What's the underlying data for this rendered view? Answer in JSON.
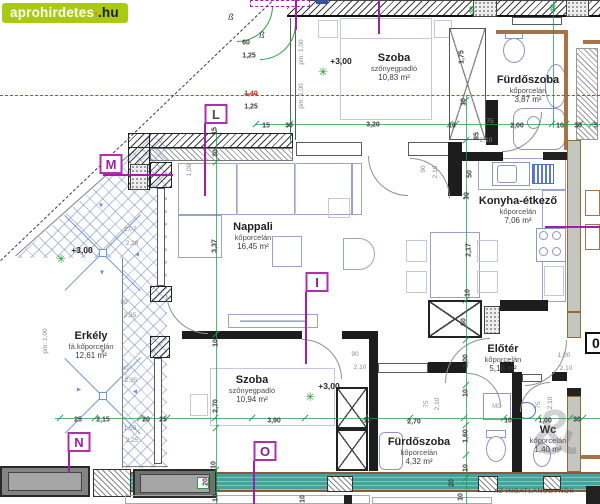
{
  "site_badge": {
    "name": "aprohirdetes",
    "dot": "▪",
    "tld": ".hu"
  },
  "colors": {
    "logo_green": "#a9ca10",
    "logo_orange": "#f07a00",
    "marker_magenta": "#b12fae",
    "dim_green": "#1f9e4c",
    "axis_red": "#cd3b2c",
    "balcony_teal": "#47a29a",
    "wall_brown": "#a97147",
    "hatch_blue": "#7d8cc3"
  },
  "rooms": [
    {
      "name": "Szoba",
      "floor": "szőnyegpadló",
      "area": "10,83 m²",
      "x": 394,
      "y": 52
    },
    {
      "name": "Fürdőszoba",
      "floor": "kőporcelán",
      "area": "3,87 m²",
      "x": 528,
      "y": 74
    },
    {
      "name": "Nappali",
      "floor": "kőporcelán",
      "area": "16,45 m²",
      "x": 253,
      "y": 221
    },
    {
      "name": "Konyha-étkező",
      "floor": "kőporcelán",
      "area": "7,06 m²",
      "x": 518,
      "y": 195
    },
    {
      "name": "Erkély",
      "floor": "fá.kőporcelán",
      "area": "12,61 m²",
      "x": 91,
      "y": 330
    },
    {
      "name": "Szoba",
      "floor": "szőnyegpadló",
      "area": "10,94 m²",
      "x": 252,
      "y": 374
    },
    {
      "name": "Fürdőszoba",
      "floor": "kőporcelán",
      "area": "4,32 m²",
      "x": 419,
      "y": 436
    },
    {
      "name": "Előtér",
      "floor": "kőporcelán",
      "area": "5,18 m²",
      "x": 503,
      "y": 343
    },
    {
      "name": "Wc",
      "floor": "kőporcelán",
      "area": "1,40 m²",
      "x": 548,
      "y": 424
    }
  ],
  "markers": [
    {
      "letter": "L",
      "x": 216,
      "y": 114,
      "color": "#4a4a4a"
    },
    {
      "letter": "M",
      "x": 111,
      "y": 164,
      "color": "#a021a0"
    },
    {
      "letter": "I",
      "x": 317,
      "y": 282,
      "color": "#7d2580"
    },
    {
      "letter": "N",
      "x": 79,
      "y": 442,
      "color": "#a021a0"
    },
    {
      "letter": "O",
      "x": 265,
      "y": 451,
      "color": "#7d2580"
    }
  ],
  "levels": [
    {
      "label": "+3,00",
      "x": 341,
      "y": 61,
      "star_x": 323,
      "star_y": 72
    },
    {
      "label": "+3,00",
      "x": 82,
      "y": 250,
      "star_x": 61,
      "star_y": 259
    },
    {
      "label": "+3,00",
      "x": 329,
      "y": 386,
      "star_x": 310,
      "star_y": 397
    }
  ],
  "dims": [
    {
      "t": "60",
      "x": 246,
      "y": 43
    },
    {
      "t": "1,25",
      "x": 249,
      "y": 56
    },
    {
      "t": "1,40",
      "x": 251,
      "y": 94,
      "c": "R"
    },
    {
      "t": "1,25",
      "x": 251,
      "y": 107
    },
    {
      "t": "pm: 1,00",
      "x": 302,
      "y": 52,
      "r": 1,
      "c": "g"
    },
    {
      "t": "pm: 1,00",
      "x": 302,
      "y": 96,
      "r": 1,
      "c": "g"
    },
    {
      "t": "30",
      "x": 473,
      "y": 10,
      "r": 1,
      "c": "G"
    },
    {
      "t": "30",
      "x": 554,
      "y": 8,
      "r": 1,
      "c": "G"
    },
    {
      "t": "1,75",
      "x": 462,
      "y": 57,
      "r": 1
    },
    {
      "t": "15",
      "x": 266,
      "y": 126
    },
    {
      "t": "30",
      "x": 289,
      "y": 126
    },
    {
      "t": "3,20",
      "x": 373,
      "y": 125
    },
    {
      "t": "10",
      "x": 452,
      "y": 126
    },
    {
      "t": "2,00",
      "x": 517,
      "y": 126
    },
    {
      "t": "10",
      "x": 560,
      "y": 126
    },
    {
      "t": "30",
      "x": 578,
      "y": 126
    },
    {
      "t": "5",
      "x": 596,
      "y": 126
    },
    {
      "t": "75",
      "x": 490,
      "y": 122,
      "c": "g"
    },
    {
      "t": "2,10",
      "x": 486,
      "y": 141,
      "c": "g"
    },
    {
      "t": "85",
      "x": 477,
      "y": 136,
      "r": 1
    },
    {
      "t": "10",
      "x": 464,
      "y": 102,
      "r": 1
    },
    {
      "t": "15",
      "x": 215,
      "y": 131,
      "r": 1
    },
    {
      "t": "30",
      "x": 216,
      "y": 153,
      "r": 1
    },
    {
      "t": "1,00",
      "x": 190,
      "y": 170,
      "r": 1,
      "c": "g"
    },
    {
      "t": "3,37",
      "x": 215,
      "y": 246,
      "r": 1
    },
    {
      "t": "90",
      "x": 424,
      "y": 169,
      "r": 1,
      "c": "g"
    },
    {
      "t": "2,10",
      "x": 436,
      "y": 172,
      "r": 1,
      "c": "g"
    },
    {
      "t": "50",
      "x": 470,
      "y": 174,
      "r": 1
    },
    {
      "t": "10",
      "x": 467,
      "y": 196,
      "r": 1
    },
    {
      "t": "2,17",
      "x": 469,
      "y": 250,
      "r": 1
    },
    {
      "t": "10",
      "x": 468,
      "y": 293,
      "r": 1
    },
    {
      "t": "60",
      "x": 464,
      "y": 322,
      "r": 1
    },
    {
      "t": "2,07",
      "x": 130,
      "y": 230,
      "c": "g"
    },
    {
      "t": "2,28",
      "x": 132,
      "y": 244,
      "c": "g"
    },
    {
      "t": "80",
      "x": 124,
      "y": 303,
      "c": "g"
    },
    {
      "t": "2,35",
      "x": 130,
      "y": 316,
      "c": "g"
    },
    {
      "t": "80",
      "x": 125,
      "y": 369,
      "c": "g"
    },
    {
      "t": "2,35",
      "x": 131,
      "y": 381,
      "c": "g"
    },
    {
      "t": "pm: 1,00",
      "x": 46,
      "y": 341,
      "r": 1,
      "c": "g"
    },
    {
      "t": "25",
      "x": 78,
      "y": 420
    },
    {
      "t": "2,15",
      "x": 103,
      "y": 420
    },
    {
      "t": "20",
      "x": 146,
      "y": 420
    },
    {
      "t": "25",
      "x": 163,
      "y": 420
    },
    {
      "t": "1,50",
      "x": 130,
      "y": 429,
      "c": "g"
    },
    {
      "t": "2,25",
      "x": 132,
      "y": 441,
      "c": "g"
    },
    {
      "t": "10",
      "x": 216,
      "y": 343,
      "r": 1
    },
    {
      "t": "2,70",
      "x": 216,
      "y": 406,
      "r": 1
    },
    {
      "t": "90",
      "x": 355,
      "y": 355,
      "c": "g"
    },
    {
      "t": "2,10",
      "x": 360,
      "y": 368,
      "c": "g"
    },
    {
      "t": "3,90",
      "x": 274,
      "y": 421
    },
    {
      "t": "10",
      "x": 367,
      "y": 421
    },
    {
      "t": "2,70",
      "x": 414,
      "y": 422
    },
    {
      "t": "75",
      "x": 427,
      "y": 404,
      "r": 1,
      "c": "g"
    },
    {
      "t": "2,10",
      "x": 438,
      "y": 404,
      "r": 1,
      "c": "g"
    },
    {
      "t": "75",
      "x": 539,
      "y": 405,
      "r": 1,
      "c": "g"
    },
    {
      "t": "2,10",
      "x": 551,
      "y": 403,
      "r": 1,
      "c": "g"
    },
    {
      "t": "1,00",
      "x": 564,
      "y": 356,
      "c": "g"
    },
    {
      "t": "2,10",
      "x": 566,
      "y": 369,
      "c": "g"
    },
    {
      "t": "1,00",
      "x": 466,
      "y": 361,
      "r": 1
    },
    {
      "t": "10",
      "x": 466,
      "y": 393,
      "r": 1
    },
    {
      "t": "1,60",
      "x": 466,
      "y": 436,
      "r": 1
    },
    {
      "t": "10",
      "x": 466,
      "y": 468,
      "r": 1
    },
    {
      "t": "20",
      "x": 452,
      "y": 483,
      "r": 1
    },
    {
      "t": "10",
      "x": 461,
      "y": 497,
      "r": 1
    },
    {
      "t": "10",
      "x": 508,
      "y": 421
    },
    {
      "t": "1,00",
      "x": 545,
      "y": 421
    },
    {
      "t": "30",
      "x": 577,
      "y": 420
    },
    {
      "t": "10",
      "x": 214,
      "y": 465,
      "r": 1
    },
    {
      "t": "20",
      "x": 206,
      "y": 482,
      "r": 1
    },
    {
      "t": "10",
      "x": 216,
      "y": 498,
      "r": 1
    },
    {
      "t": "10",
      "x": 303,
      "y": 499,
      "r": 1
    }
  ],
  "misc_labels": [
    {
      "text": "ß",
      "x": 231,
      "y": 17,
      "cls": "beta"
    },
    {
      "text": "ß",
      "x": 262,
      "y": 35,
      "cls": "beta"
    },
    {
      "text": "MG",
      "x": 497,
      "y": 407,
      "cls": "mg"
    }
  ],
  "door_number": {
    "text": "0",
    "x": 585,
    "y": 343
  },
  "watermark": {
    "symbol": "&",
    "agency": "AZ INGATLANÜGYNÖK"
  }
}
